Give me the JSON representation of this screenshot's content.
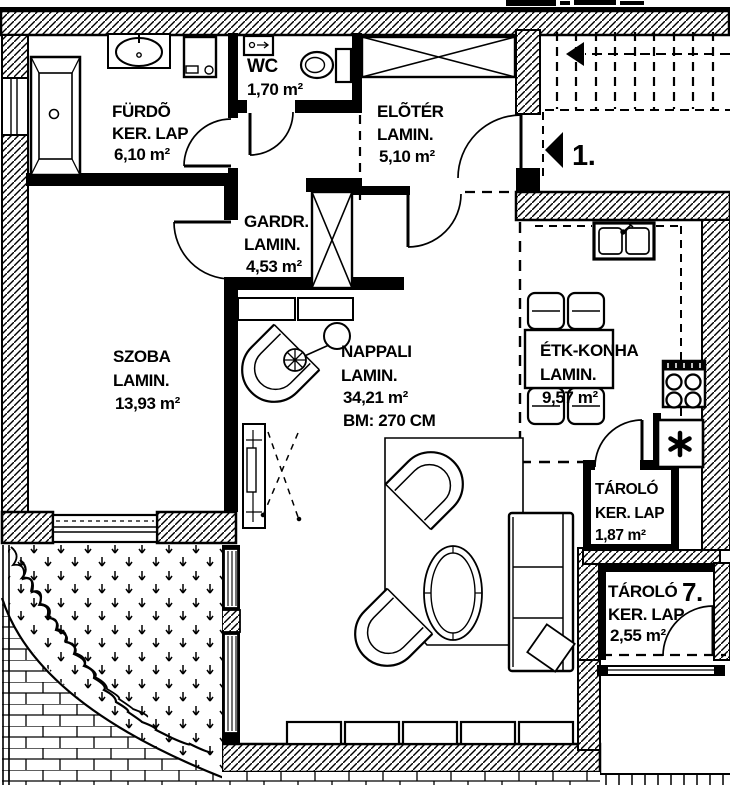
{
  "title": "Apartment floor plan",
  "colors": {
    "ink": "#000000",
    "paper": "#ffffff"
  },
  "rooms": [
    {
      "name": "FÜRDÕ",
      "finish": "KER. LAP",
      "area": "6,10 m²"
    },
    {
      "name": "WC",
      "area": "1,70 m²"
    },
    {
      "name": "ELÕTÉR",
      "finish": "LAMIN.",
      "area": "5,10 m²"
    },
    {
      "name": "GARDR.",
      "finish": "LAMIN.",
      "area": "4,53 m²"
    },
    {
      "name": "SZOBA",
      "finish": "LAMIN.",
      "area": "13,93 m²"
    },
    {
      "name": "NAPPALI",
      "finish": "LAMIN.",
      "area": "34,21 m²",
      "ceiling_height": "BM: 270 CM"
    },
    {
      "name": "ÉTK-KONHA",
      "finish": "LAMIN.",
      "area": "9,57 m²"
    },
    {
      "name": "TÁROLÓ",
      "finish": "KER. LAP",
      "area": "1,87 m²"
    },
    {
      "name": "TÁROLÓ",
      "number": "7.",
      "finish": "KER. LAP",
      "area": "2,55 m²"
    }
  ],
  "markers": {
    "entrance_label": "1."
  }
}
